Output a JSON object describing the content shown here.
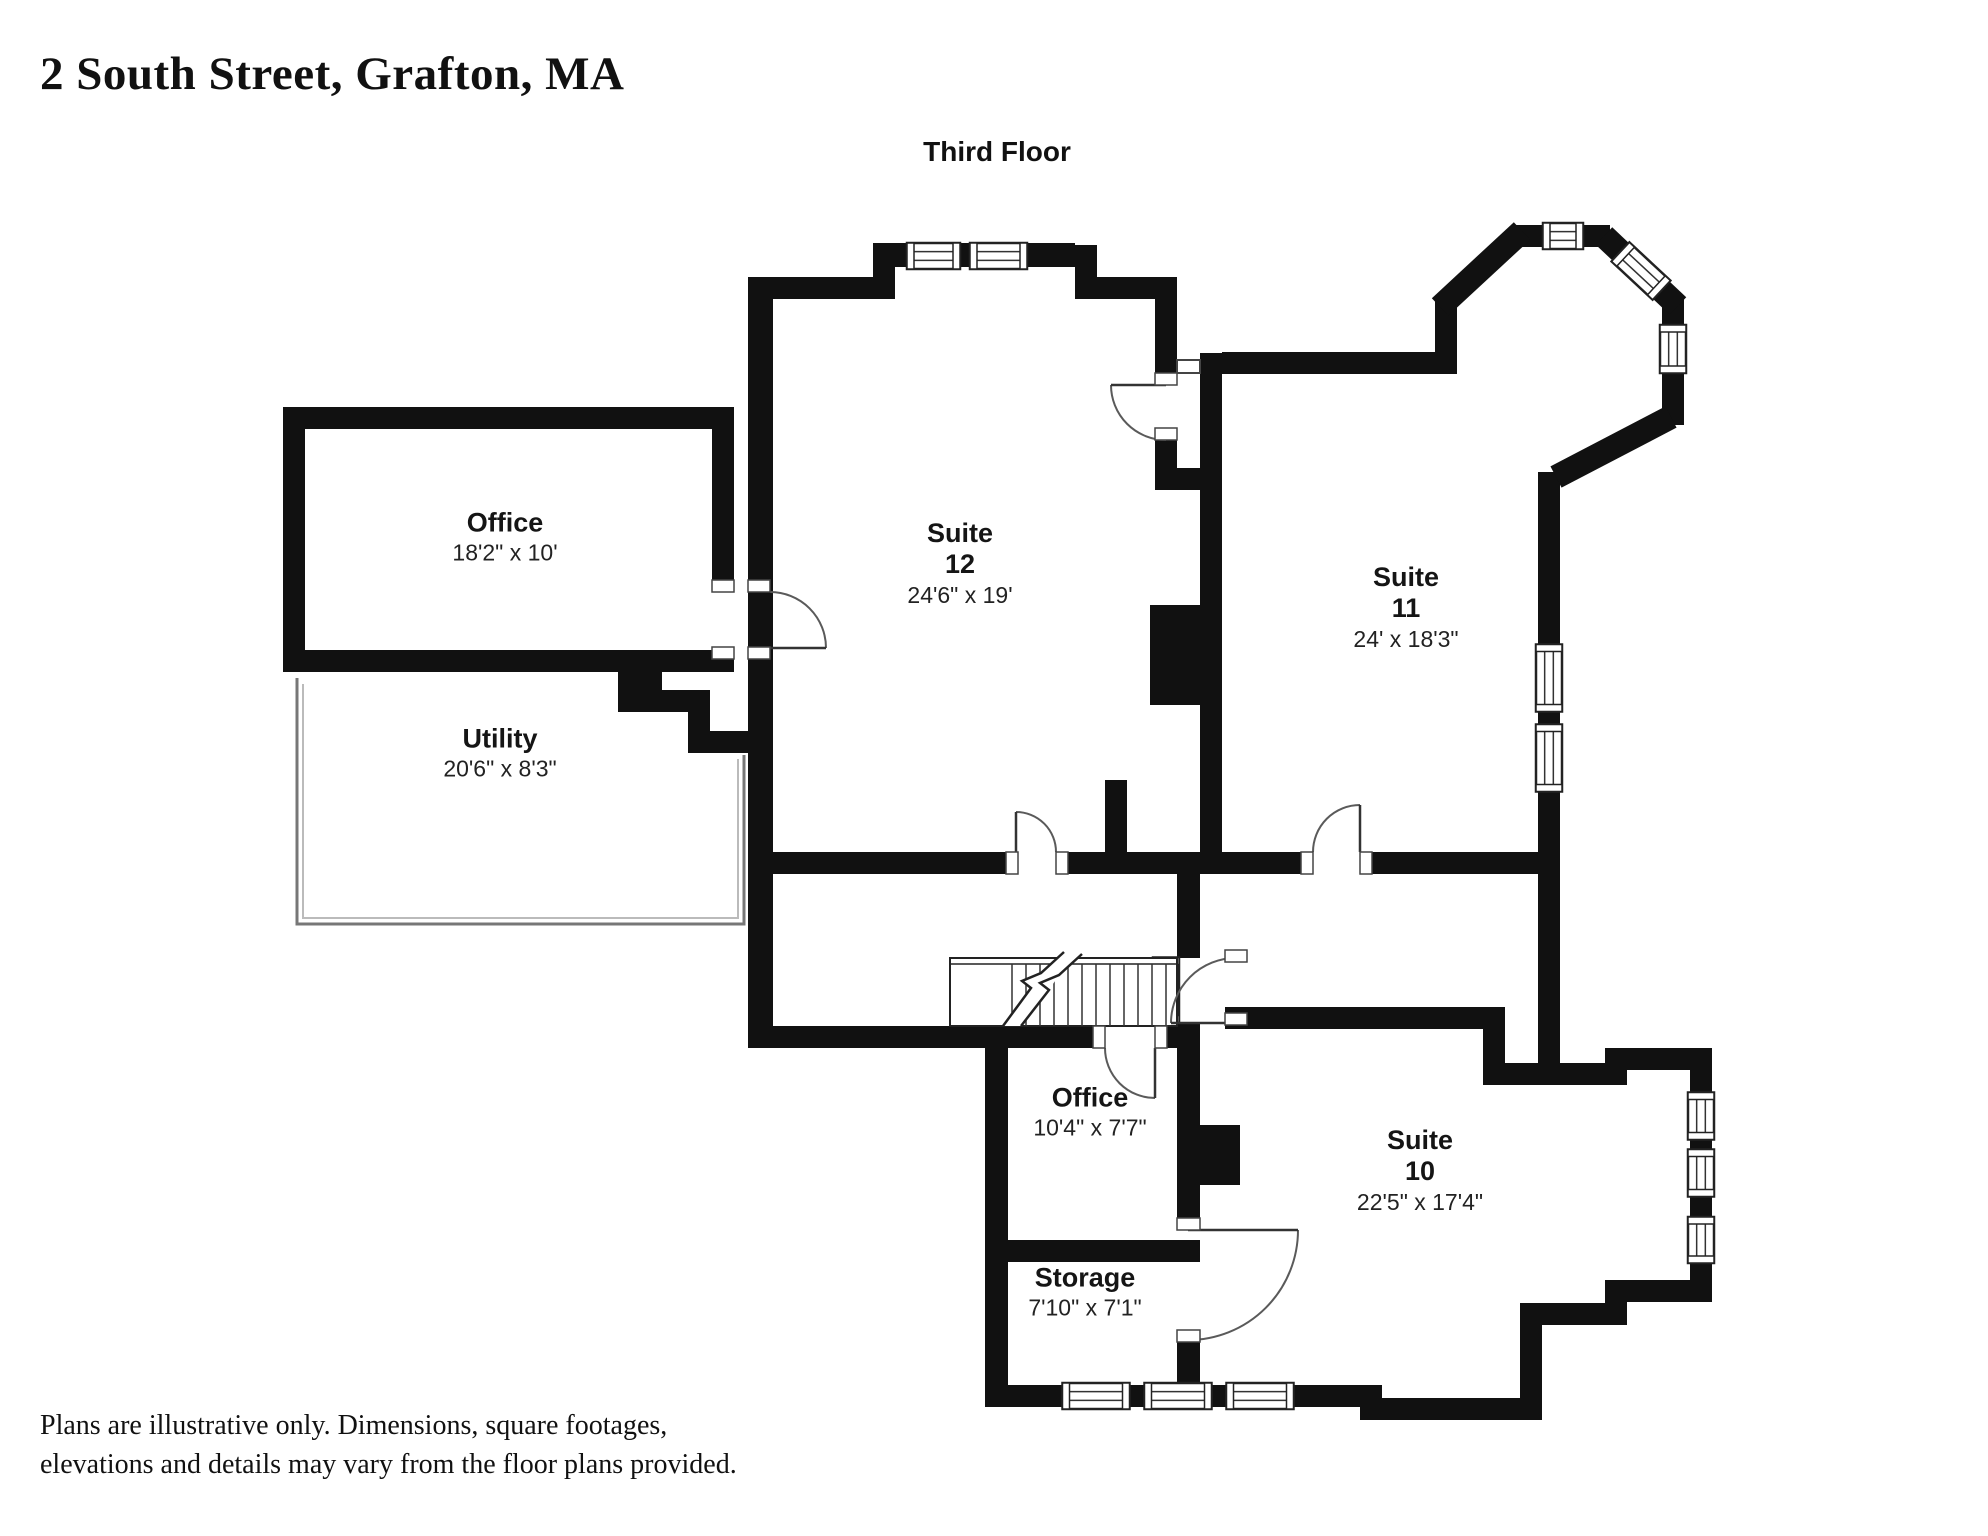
{
  "header": {
    "address": "2 South Street, Grafton, MA",
    "floor_label": "Third Floor"
  },
  "rooms": [
    {
      "name": "Office",
      "dims": "18'2\" x 10'"
    },
    {
      "name": "Utility",
      "dims": "20'6\" x 8'3\""
    },
    {
      "name": "Suite",
      "number": "12",
      "dims": "24'6\" x 19'"
    },
    {
      "name": "Suite",
      "number": "11",
      "dims": "24' x 18'3\""
    },
    {
      "name": "Office",
      "dims": "10'4\" x 7'7\""
    },
    {
      "name": "Storage",
      "dims": "7'10\" x 7'1\""
    },
    {
      "name": "Suite",
      "number": "10",
      "dims": "22'5\" x 17'4\""
    }
  ],
  "footer": {
    "disclaimer_line1": "Plans are illustrative only. Dimensions, square footages,",
    "disclaimer_line2": "elevations and details may vary from the floor plans provided."
  },
  "colors": {
    "wall": "#111111",
    "text": "#1c1c1c",
    "background": "#ffffff",
    "door_arc": "#5a5a5a"
  }
}
